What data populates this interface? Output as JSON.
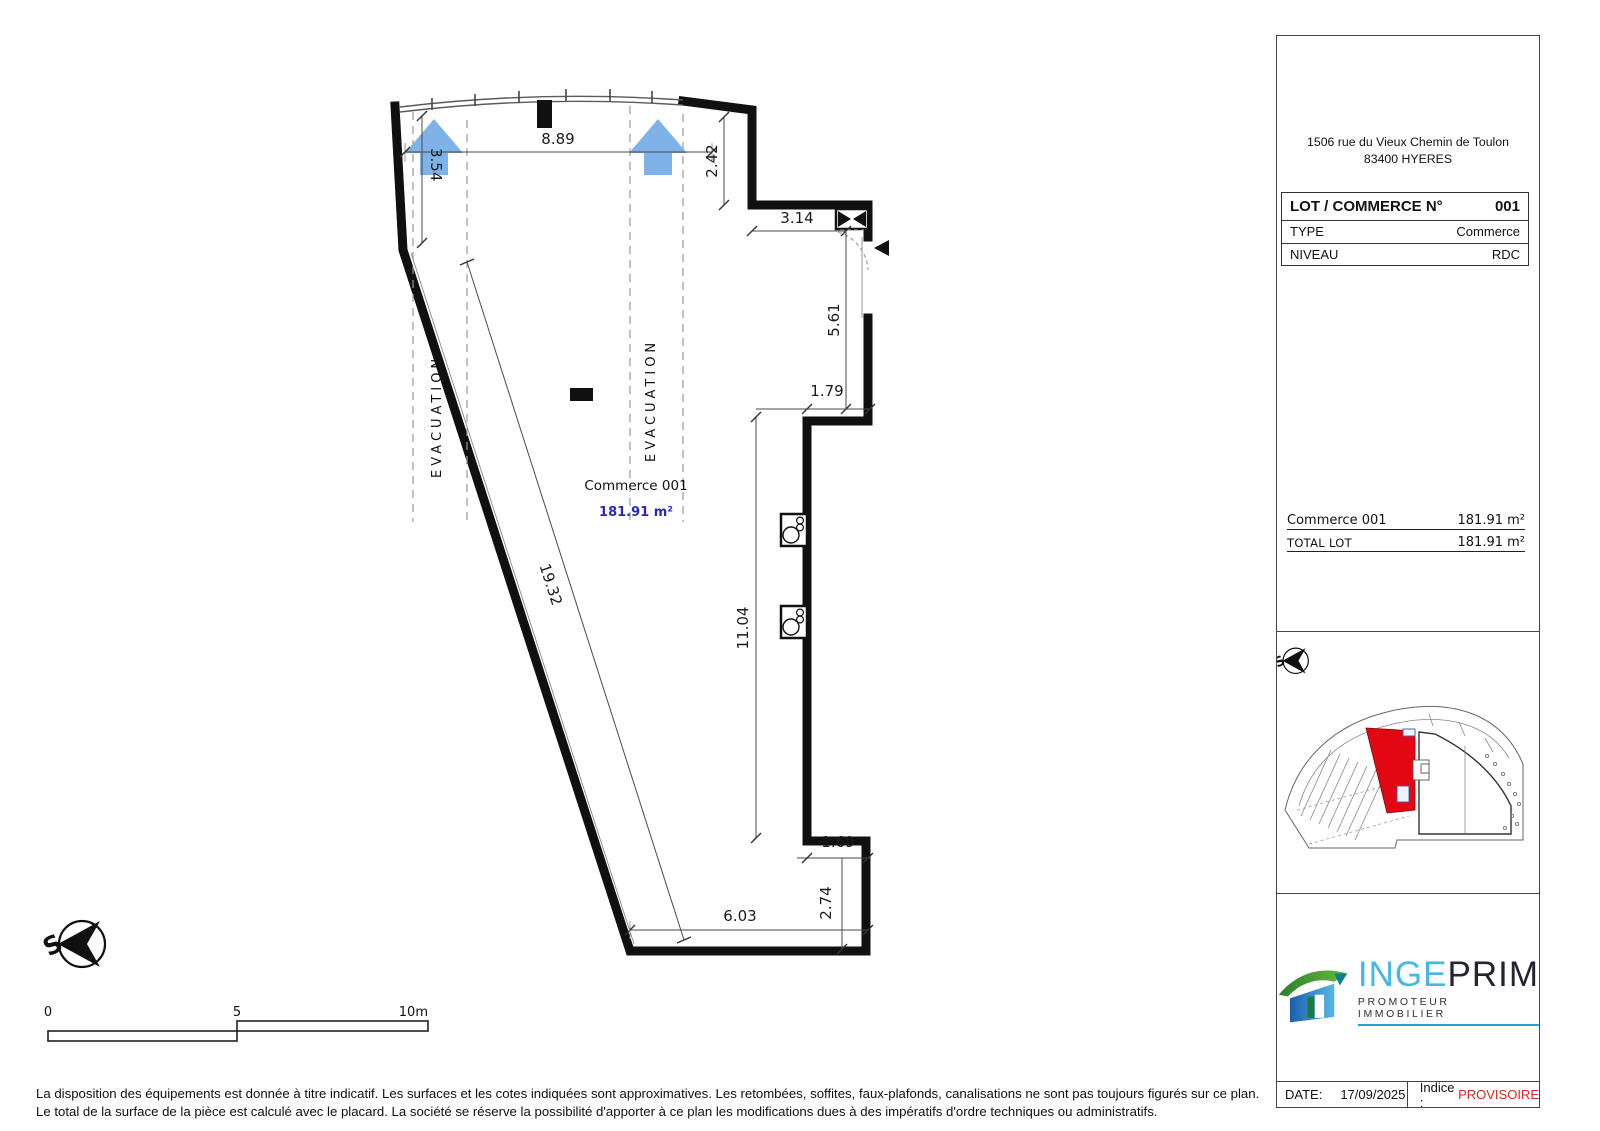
{
  "plan": {
    "room": {
      "label": "Commerce 001",
      "area": "181.91 m²"
    },
    "evacuation": {
      "label": "EVACUATION"
    },
    "dims": {
      "shopfront_width": "8.89",
      "shopfront_left": "3.54",
      "right_top": "2.42",
      "corridor_top": "3.14",
      "right_upper": "5.61",
      "recess_top": "1.79",
      "right_inner": "11.04",
      "recess_bottom": "1.69",
      "bottom_right": "2.74",
      "bottom_width": "6.03",
      "diagonal_wall": "19.32"
    },
    "compass": {
      "letter": "S"
    },
    "scale_bar": {
      "start": "0",
      "middle": "5",
      "end": "10m"
    }
  },
  "sidebar": {
    "address": {
      "line1": "1506 rue du Vieux Chemin de Toulon",
      "line2": "83400 HYERES"
    },
    "lot_table": {
      "title": "LOT / COMMERCE N°",
      "number": "001",
      "type_label": "TYPE",
      "type_value": "Commerce",
      "level_label": "NIVEAU",
      "level_value": "RDC"
    },
    "surfaces": {
      "item_label": "Commerce 001",
      "item_value": "181.91 m²",
      "total_label": "TOTAL LOT",
      "total_value": "181.91 m²"
    },
    "logo": {
      "name_left": "INGE",
      "name_right": "PRIM",
      "tagline": "PROMOTEUR IMMOBILIER"
    },
    "footer": {
      "date_label": "DATE:",
      "date_value": "17/09/2025",
      "indice_label": "Indice :",
      "indice_value": "PROVISOIRE"
    }
  },
  "disclaimer": {
    "line1": "La disposition des équipements est donnée à titre indicatif. Les surfaces et les cotes indiquées sont approximatives. Les retombées, soffites, faux-plafonds, canalisations ne sont pas toujours figurés sur ce plan.",
    "line2": "Le total de la surface de la pièce est calculé avec le placard. La société se réserve la possibilité d'apporter à ce plan les modifications dues à des impératifs d'ordre techniques ou administratifs."
  },
  "colors": {
    "evacuation_arrow": "#7FB2E8",
    "area_text": "#2A2AB4",
    "lot_highlight": "#E30613",
    "provisoire": "#D9261F",
    "logo_blue": "#45B6E8",
    "logo_dark": "#232333",
    "logo_green": "#3FA33C"
  }
}
